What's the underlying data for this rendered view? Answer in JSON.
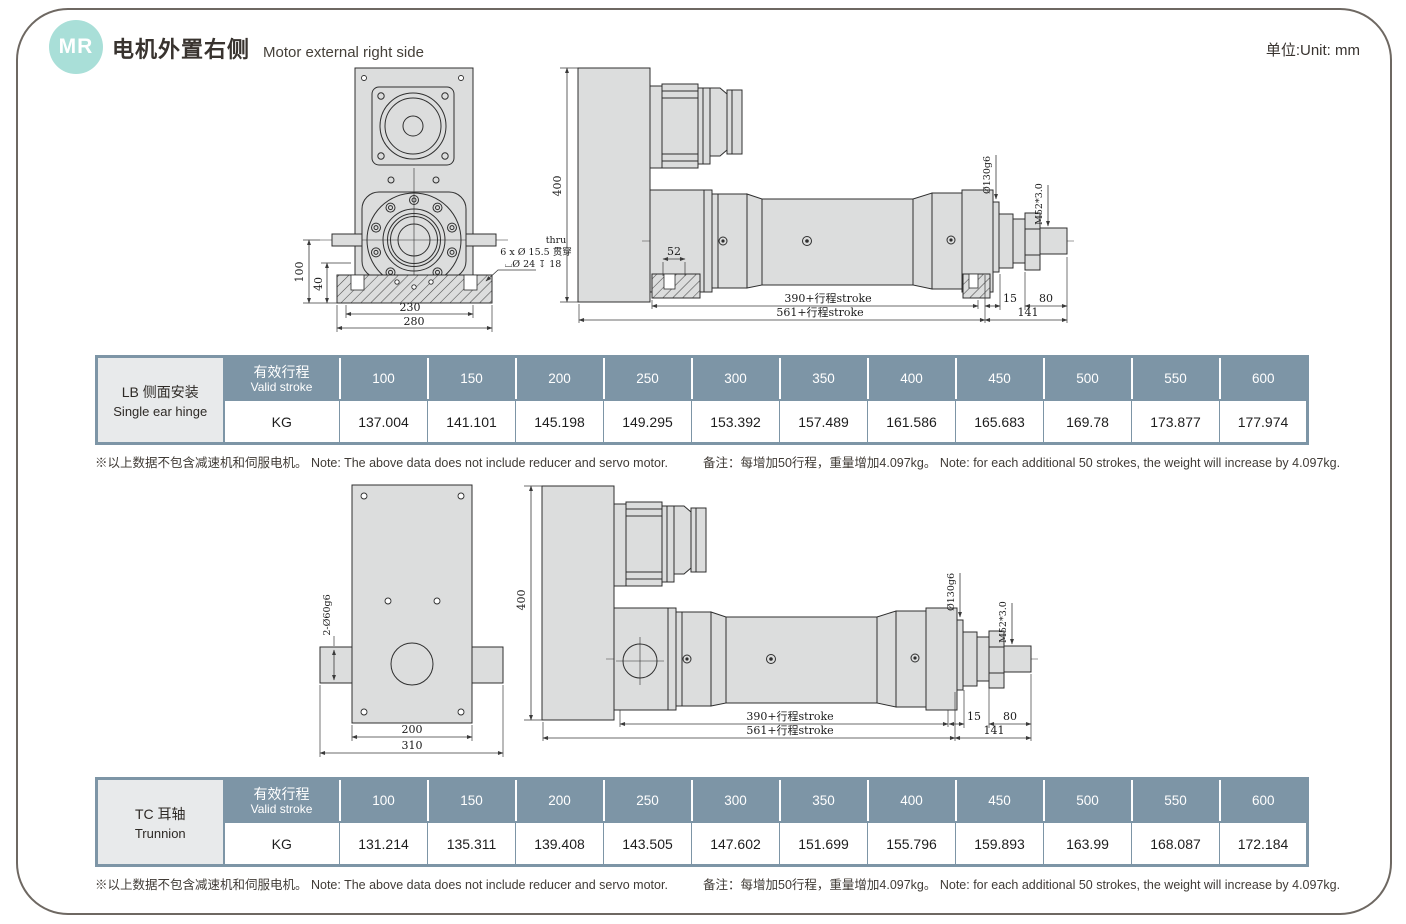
{
  "header": {
    "badge": "MR",
    "title_zh": "电机外置右侧",
    "title_en": "Motor external right side",
    "unit": "单位:Unit: mm"
  },
  "tables": [
    {
      "label_zh": "LB 侧面安装",
      "label_en": "Single ear hinge",
      "stroke_zh": "有效行程",
      "stroke_en": "Valid stroke",
      "unit_row": "KG",
      "strokes": [
        "100",
        "150",
        "200",
        "250",
        "300",
        "350",
        "400",
        "450",
        "500",
        "550",
        "600"
      ],
      "weights": [
        "137.004",
        "141.101",
        "145.198",
        "149.295",
        "153.392",
        "157.489",
        "161.586",
        "165.683",
        "169.78",
        "173.877",
        "177.974"
      ]
    },
    {
      "label_zh": "TC 耳轴",
      "label_en": "Trunnion",
      "stroke_zh": "有效行程",
      "stroke_en": "Valid stroke",
      "unit_row": "KG",
      "strokes": [
        "100",
        "150",
        "200",
        "250",
        "300",
        "350",
        "400",
        "450",
        "500",
        "550",
        "600"
      ],
      "weights": [
        "131.214",
        "135.311",
        "139.408",
        "143.505",
        "147.602",
        "151.699",
        "155.796",
        "159.893",
        "163.99",
        "168.087",
        "172.184"
      ]
    }
  ],
  "notes": {
    "no_motor": "※以上数据不包含减速机和伺服电机。 Note: The above data does not include reducer and servo motor.",
    "per_stroke": "备注：每增加50行程，重量增加4.097kg。 Note: for each additional 50 strokes, the weight will increase by 4.097kg."
  },
  "dims": {
    "v400": "400",
    "h100": "100",
    "h40": "40",
    "w230": "230",
    "w280": "280",
    "w52": "52",
    "stroke390": "390+行程stroke",
    "stroke561": "561+行程stroke",
    "d15": "15",
    "d80": "80",
    "d141": "141",
    "dia130": "Ø130g6",
    "m52": "M52*3.0",
    "w200": "200",
    "w310": "310",
    "pin60": "2-Ø60g6",
    "callout_thru": "thru",
    "callout_holes": "6 x Ø 15.5 贯穿",
    "callout_cbore": "⌴Ø 24 ↧ 18"
  },
  "colors": {
    "badge_bg": "#a9dfd8",
    "table_header_bg": "#7d95a6",
    "table_label_bg": "#e8eaeb",
    "drawing_fill": "#dcdddd",
    "page_border": "#6e6862"
  }
}
